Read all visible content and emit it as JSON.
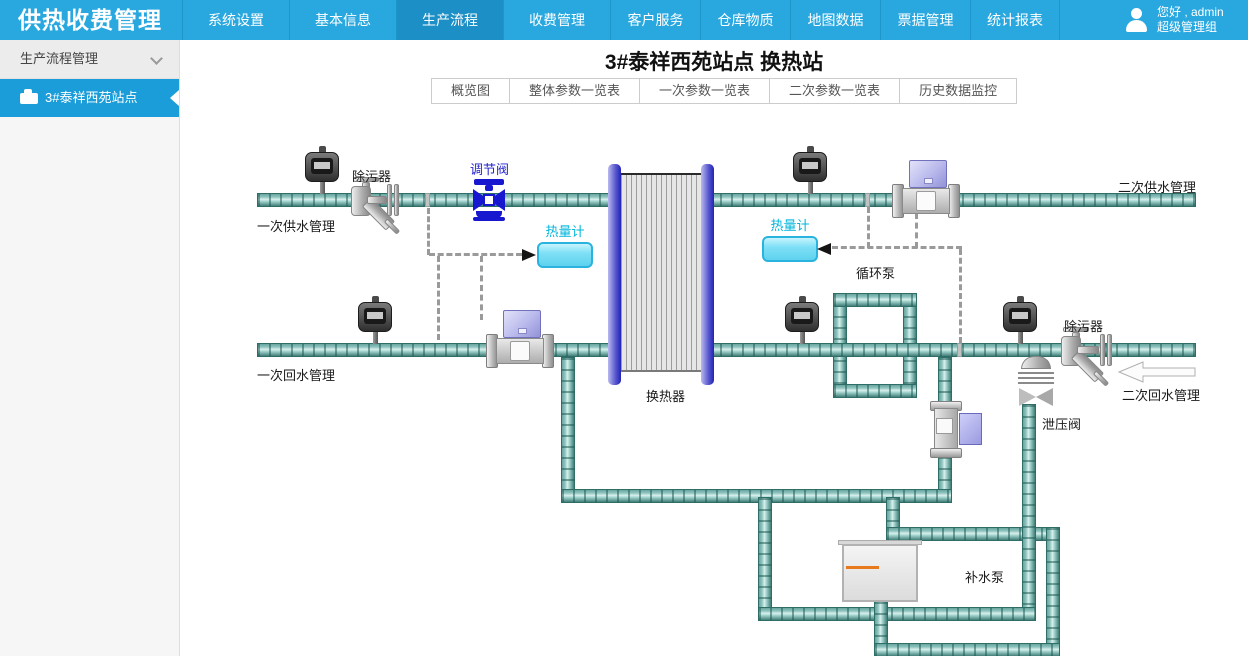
{
  "header": {
    "logo": "供热收费管理",
    "tabs": [
      {
        "label": "系统设置",
        "active": false
      },
      {
        "label": "基本信息",
        "active": false
      },
      {
        "label": "生产流程",
        "active": true
      },
      {
        "label": "收费管理",
        "active": false
      },
      {
        "label": "客户服务",
        "active": false
      },
      {
        "label": "仓库物质",
        "active": false
      },
      {
        "label": "地图数据",
        "active": false
      },
      {
        "label": "票据管理",
        "active": false
      },
      {
        "label": "统计报表",
        "active": false
      }
    ],
    "user": {
      "greeting": "您好 , admin",
      "role": "超级管理组"
    }
  },
  "sidebar": {
    "group": "生产流程管理",
    "station": "3#泰祥西苑站点"
  },
  "main": {
    "title": "3#泰祥西苑站点 换热站",
    "view_buttons": [
      "概览图",
      "整体参数一览表",
      "一次参数一览表",
      "二次参数一览表",
      "历史数据监控"
    ]
  },
  "diagram": {
    "labels": {
      "primary_supply": "一次供水管理",
      "primary_return": "一次回水管理",
      "secondary_supply": "二次供水管理",
      "secondary_return": "二次回水管理",
      "strainer_left": "除污器",
      "strainer_right": "除污器",
      "regulating_valve": "调节阀",
      "heat_meter_left": "热量计",
      "heat_meter_right": "热量计",
      "circulation_pump": "循环泵",
      "heat_exchanger": "换热器",
      "relief_valve": "泄压阀",
      "makeup_pump": "补水泵"
    },
    "colors": {
      "header_blue": "#29a8e0",
      "active_tab_blue": "#1b8fc6",
      "sidebar_active_blue": "#1b9dd9",
      "pipe_teal": "#4f948d",
      "valve_blue": "#1717cf",
      "heat_meter_cyan": "#00b6dc",
      "meter_box_lavender": "#b9b9ec",
      "tank_level_orange": "#e8791d"
    }
  }
}
